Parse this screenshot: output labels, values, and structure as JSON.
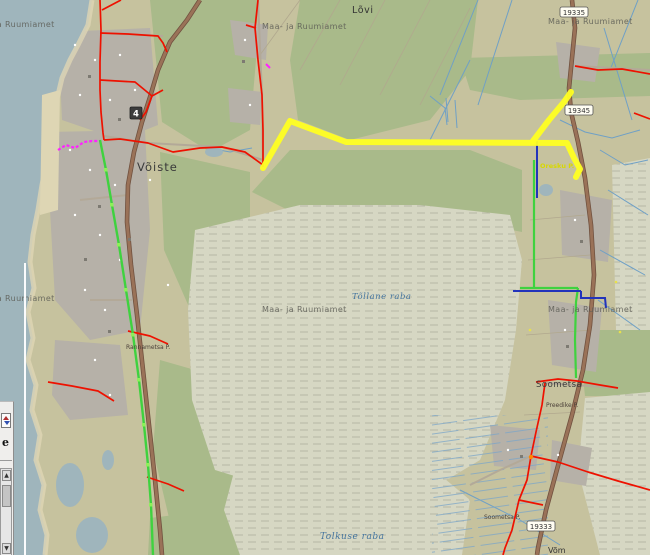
{
  "watermark": {
    "text": "Maa- ja Ruumiamet"
  },
  "labels": {
    "lovi": "Lõvi",
    "voiste": "Võiste",
    "soometsa": "Soometsa",
    "bog_north": "Tõllane raba",
    "bog_south": "Tolkuse raba",
    "yellow_line": "Oresku P.",
    "preedike": "Preedike P.",
    "soometsa_p": "Soometsa P.",
    "rannametsa_p": "Rannametsa P.",
    "bottom_partial": "Võm"
  },
  "road_shields": {
    "main": "4",
    "north": "19335",
    "mid": "19345",
    "south": "19333"
  },
  "panel": {
    "letter": "e",
    "scroll_up": "▲",
    "scroll_down": "▼"
  },
  "colors": {
    "sea": "#9fb5bc",
    "field": "#c6c29e",
    "forest": "#a9ba8a",
    "bog": "#d6d7c3",
    "builtup": "#b6b1a8",
    "road_major": "#9a7258",
    "road_casing": "#70513f",
    "road_minor": "#b3a998",
    "stream": "#6fa0c6",
    "line_red": "#ee1100",
    "line_green": "#3fd23f",
    "line_green_marker": "#8df05a",
    "line_blue": "#2233bb",
    "line_yellow": "#ffff22",
    "line_magenta": "#ff22ff",
    "node_orange": "#ff8800",
    "watermark_gray": "#5c5c55"
  }
}
